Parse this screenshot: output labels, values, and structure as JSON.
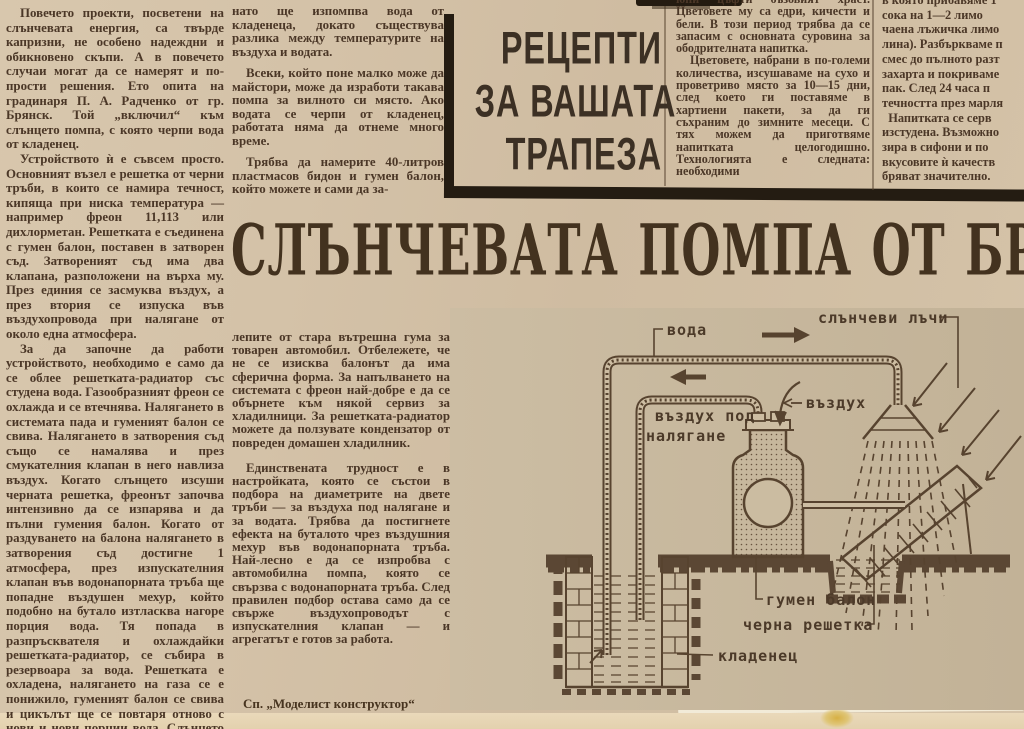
{
  "headline": {
    "text": "СЛЪНЧЕВАТА ПОМПА ОТ БРЯНСК"
  },
  "recipes_box": {
    "lines": [
      "РЕЦЕПТИ",
      "ЗА ВАШАТА",
      "ТРАПЕЗА"
    ]
  },
  "columns": {
    "col1": {
      "paragraphs": [
        "Повечето проекти, посветени на слънчевата енергия, са твърде капризни, не особено надеждни и обикновено скъпи. А в повечето случаи могат да се намерят и по-прости решения. Ето опита на градинаря П. А. Радченко от гр. Брянск. Той „включил“ към слънцето помпа, с която черпи вода от кладенец.",
        "Устройството ѝ е съвсем просто. Основният възел е решетка от черни тръби, в които се намира течност, кипяща при ниска температура — например фреон 11,113 или дихлорметан. Решетката е съединена с гумен балон, поставен в затворен съд. Затвореният съд има два клапана, разположени на върха му. През единия се засмуква въздух, а през втория се изпуска във въздухопровода при налягане от около една атмосфера.",
        "За да започне да работи устройството, необходимо е само да се облее решетката-радиатор със студена вода. Газообразният фреон се охлажда и се втечнява. Налягането в системата пада и гуменият балон се свива. Налягането в затворения съд също се намалява и през смукателния клапан в него навлиза въздух. Когато слънцето изсуши черната решетка, фреонът започва интензивно да се изпарява и да пълни гумения балон. Когато от раздуването на балона налягането в затворения съд достигне 1 атмосфера, през изпускателния клапан във водонапорната тръба ще попадне въздушен мехур, който подобно на бутало изтласква нагоре порция вода. Тя попада в разпръсквателя и охлаждайки решетката-радиатор, се събира в резервоара за вода. Решетката е охладена, налягането на газа се е понижило, гуменият балон се свива и цикълът ще се повтаря отново с нови и нови порции вода. Слънцето непрекъс-"
      ]
    },
    "col2_top": {
      "paragraphs": [
        "нато ще изпомпва вода от кладенеца, докато съществува разлика между температурите на въздуха и водата.",
        "Всеки, който поне малко може да майстори, може да изработи такава помпа за вилното си място. Ако водата се черпи от кладенец, работата няма да отнеме много време.",
        "Трябва да намерите 40-литров пластмасов бидон и гумен балон, който можете и сами да за-"
      ]
    },
    "col2_bottom": {
      "paragraphs": [
        "лепите от стара вътрешна гума за товарен автомобил. Отбележете, че не се изисква балонът да има сферична форма. За напълването на системата с фреон най-добре е да се обърнете към някой сервиз за хладилници. За решетката-радиатор можете да ползувате кондензатор от повреден домашен хладилник.",
        "Единствената трудност е в настройката, която се състои в подбора на диаметрите на двете тръби — за въздуха под налягане и за водата. Трябва да постигнете ефекта на буталото чрез въздушния мехур във водонапорната тръба. Най-лесно е да се изпробва с автомобилна помпа, която се свързва с водонапорната тръба. След правилен подбор остава само да се свърже въздухопроводът с изпускателния клапан — и агрегатът е готов за работа."
      ],
      "source": "Сп. „Моделист конструктор“"
    },
    "col3": {
      "paragraphs": [
        "юни цъфти бъзовият храст. Цветовете му са едри, кичести и бели. В този период трябва да се запасим с основната суровина за ободрителната напитка.",
        "Цветовете, набрани в по-големи количества, изсушаваме на сухо и проветриво място за 10—15 дни, след което ги поставяме в хартиени пакети, за да ги съхраним до зимните месеци. С тях можем да приготвяме напитката целогодишно. Технологията е следната: необходими"
      ]
    },
    "col4": {
      "lines": [
        "в която прибавяме 1",
        "сока на 1—2 лимо",
        "чаена лъжичка лимо",
        "лина). Разбъркваме п",
        "смес до пълното разт",
        "захарта и покриваме",
        "пак. След 24 часа п",
        "течността през марля",
        "  Напитката се серв",
        "изстудена. Възможно",
        "зира в сифони и по",
        "вкусовите ѝ качеств",
        "бряват значително."
      ]
    }
  },
  "diagram": {
    "labels": {
      "water": "вода",
      "sun_rays": "слънчеви лъчи",
      "air": "въздух",
      "air_pressure_line1": "въздух под",
      "air_pressure_line2": "налягане",
      "rubber_balloon": "гумен балон",
      "black_grid": "черна решетка",
      "well": "кладенец"
    }
  },
  "colors": {
    "paper": "#d4c2a8",
    "ink": "#4b3727",
    "headline_ink": "#43321f",
    "rule_black": "#241c12",
    "diagram_ink": "#57432f",
    "page_edge_cream": "#ead9ba",
    "scan_bed_white": "#f2ebd8"
  }
}
